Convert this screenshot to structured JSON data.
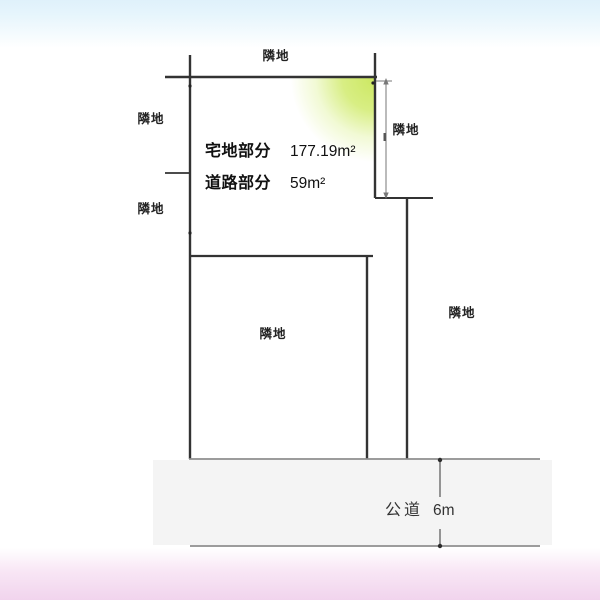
{
  "diagram": {
    "type": "land-plot-diagram",
    "neighbors": {
      "top": "隣地",
      "left_upper": "隣地",
      "left_lower": "隣地",
      "right_upper": "隣地",
      "right_far": "隣地",
      "inner": "隣地"
    },
    "areas": {
      "residential": {
        "label": "宅地部分",
        "value": "177.19m²"
      },
      "road_portion": {
        "label": "道路部分",
        "value": "59m²"
      }
    },
    "public_road": {
      "label": "公道",
      "width": "6m"
    },
    "colors": {
      "sky_band": "#dff1fb",
      "pink_band": "#f1d4ed",
      "road_fill": "#f4f4f4",
      "highlight_green": "#cfe87a",
      "boundary_line": "#333333",
      "dimension_line": "#777777"
    }
  }
}
